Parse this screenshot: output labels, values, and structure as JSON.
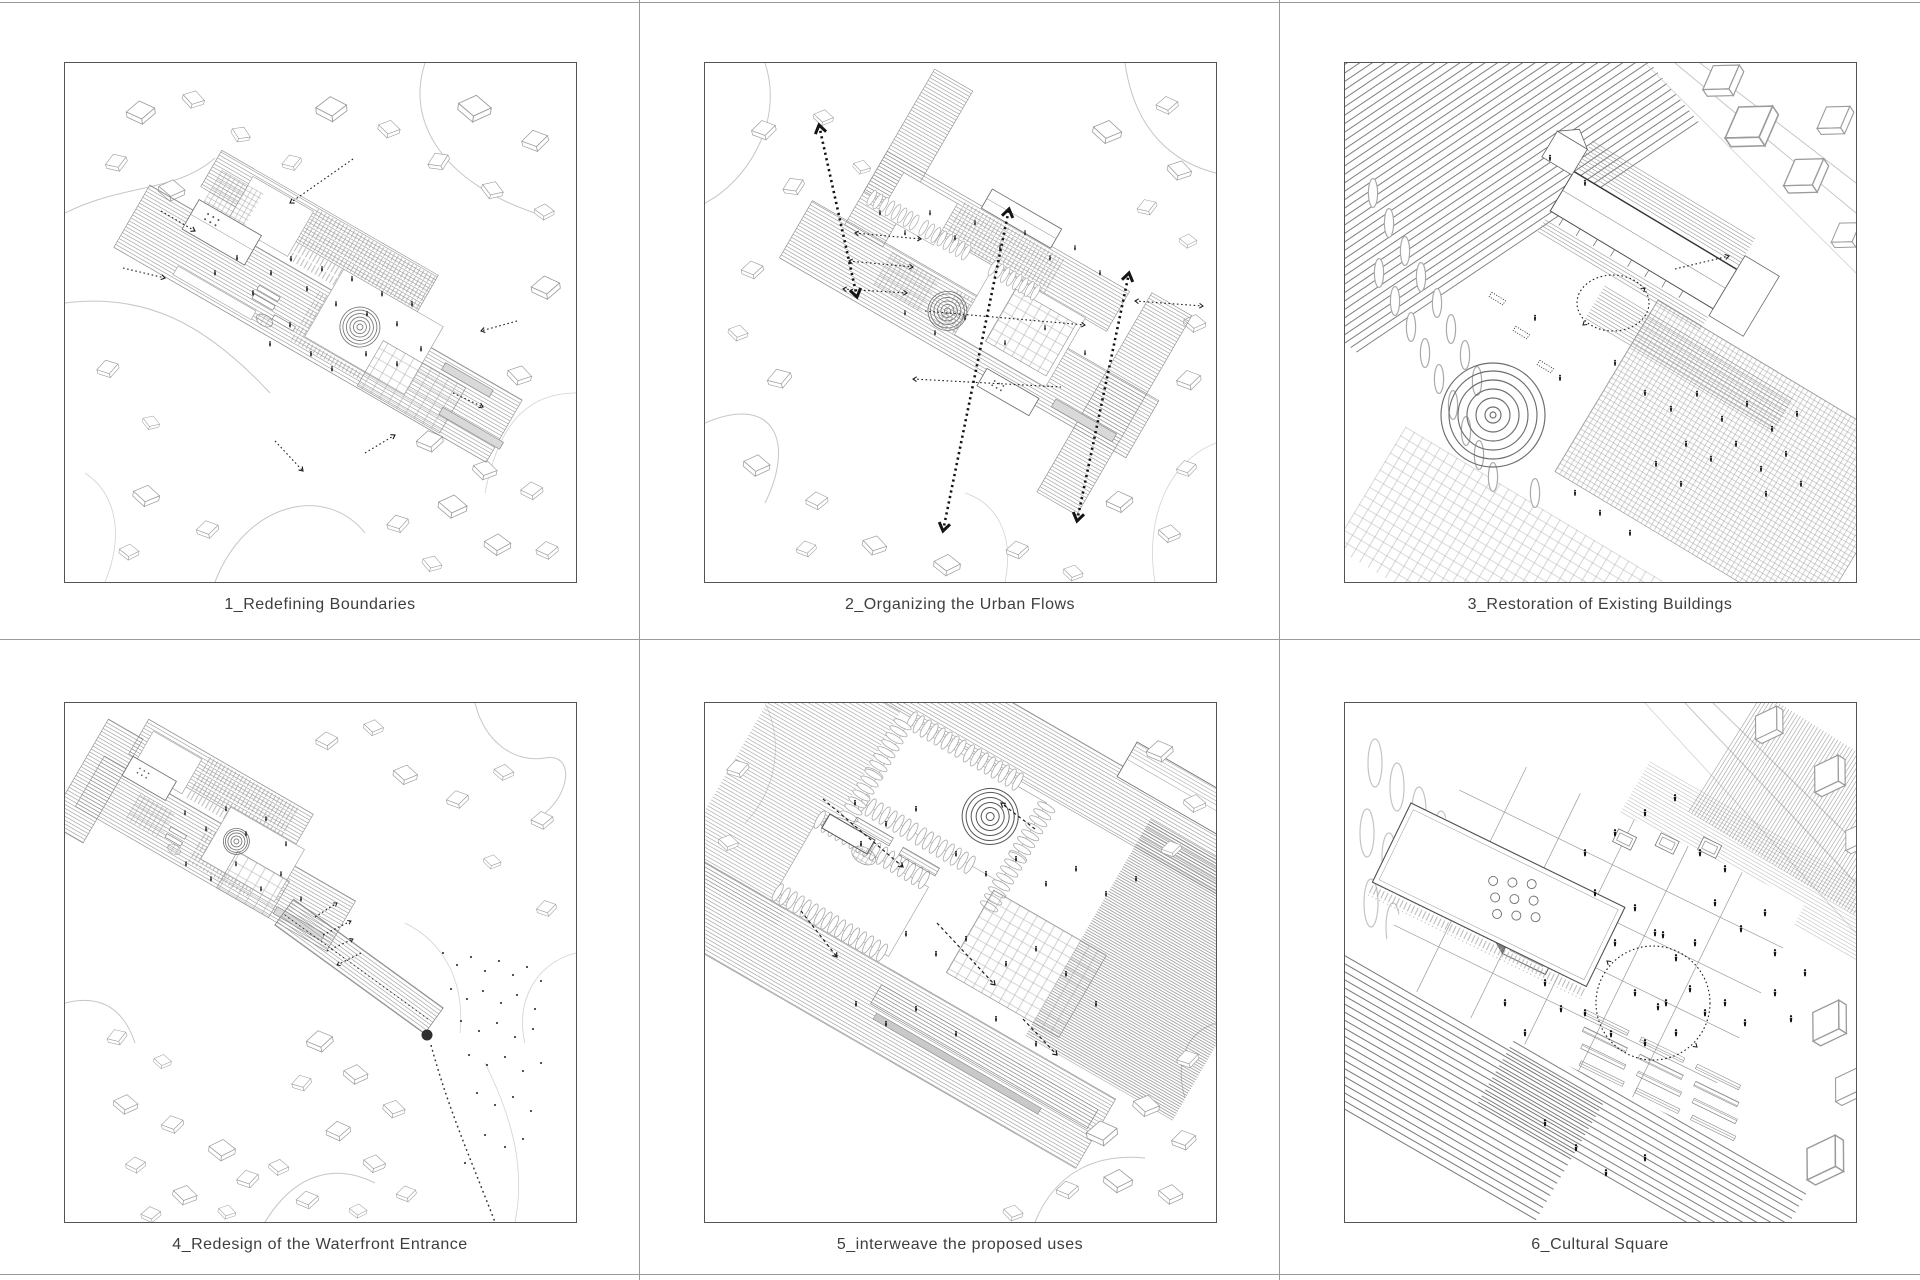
{
  "page": {
    "background": "#ffffff",
    "grid": {
      "columns": 3,
      "rows": 2,
      "divider_color": "#9a9a9a"
    },
    "frame_border_color": "#545454",
    "caption_color": "#3e3e3e",
    "linework_color": "#8c8c8c",
    "accent_black": "#1a1a1a"
  },
  "panels": [
    {
      "caption": "1_Redefining Boundaries"
    },
    {
      "caption": "2_Organizing the Urban Flows"
    },
    {
      "caption": "3_Restoration of Existing Buildings"
    },
    {
      "caption": "4_Redesign of the Waterfront Entrance"
    },
    {
      "caption": "5_interweave the proposed uses"
    },
    {
      "caption": "6_Cultural Square"
    }
  ]
}
